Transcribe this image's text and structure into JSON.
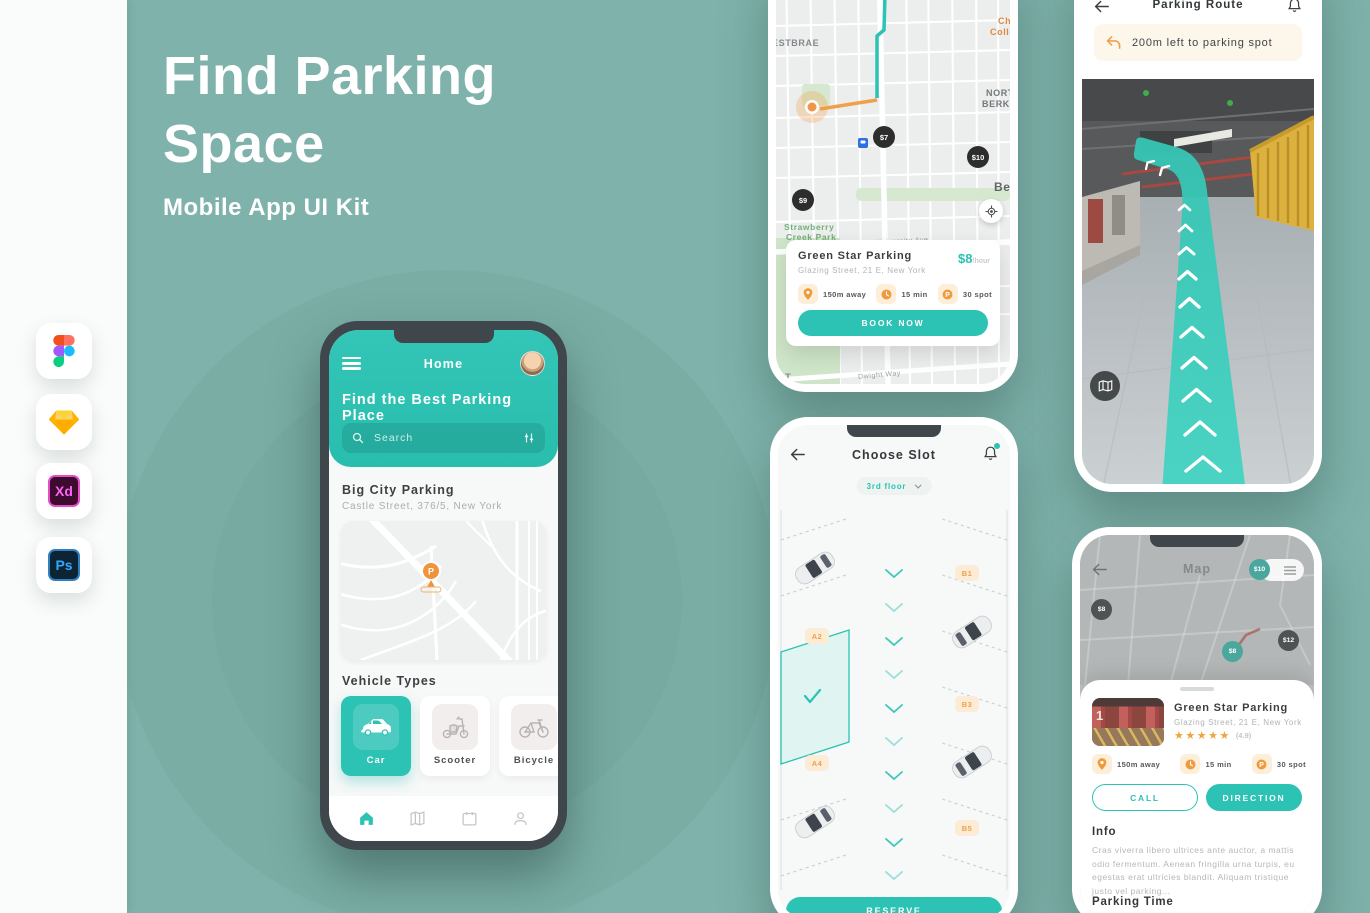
{
  "colors": {
    "accent": "#2cc2b4",
    "orange": "#f09a3e",
    "background": "#7eb2aa",
    "pin_dark": "#2d2d2d"
  },
  "hero": {
    "line1": "Find Parking",
    "line2": "Space",
    "subtitle": "Mobile App UI Kit"
  },
  "tools": {
    "xd": "Xd",
    "ps": "Ps"
  },
  "home": {
    "nav_title": "Home",
    "heading": "Find the Best Parking Place",
    "search_placeholder": "Search",
    "place_name": "Big City Parking",
    "place_address": "Castle Street, 376/5, New York",
    "vehicle_section": "Vehicle Types",
    "vehicles": [
      {
        "label": "Car"
      },
      {
        "label": "Scooter"
      },
      {
        "label": "Bicycle"
      }
    ]
  },
  "map": {
    "labels": {
      "westbrae": "ESTBRAE",
      "collection1": "Che",
      "collection2": "Collecti",
      "north1": "NORT",
      "north2": "BERKEL",
      "berkeley": "Ber",
      "park1": "Strawberry",
      "park2": "Creek Park",
      "university": "University Ave",
      "dwight": "Dwight Way",
      "est": "EST"
    },
    "pins": [
      {
        "price": "$7"
      },
      {
        "price": "$10"
      },
      {
        "price": "$9"
      }
    ],
    "card": {
      "name": "Green Star Parking",
      "address": "Glazing Street, 21 E, New York",
      "price": "$8",
      "price_unit": "/hour",
      "stats": [
        {
          "label": "150m away"
        },
        {
          "label": "15 min"
        },
        {
          "label": "30 spot"
        }
      ],
      "cta": "BOOK NOW"
    }
  },
  "slot": {
    "nav_title": "Choose Slot",
    "floor": "3rd floor",
    "left_labels": [
      {
        "id": "A2"
      },
      {
        "id": "A4"
      }
    ],
    "right_labels": [
      {
        "id": "B1"
      },
      {
        "id": "B3"
      },
      {
        "id": "B5"
      }
    ],
    "cta": "RESERVE"
  },
  "route": {
    "nav_title": "Parking Route",
    "banner": "200m left to parking spot"
  },
  "detail": {
    "nav_title": "Map",
    "pins": [
      {
        "price": "$10"
      },
      {
        "price": "$8"
      },
      {
        "price": "$8"
      },
      {
        "price": "$12"
      }
    ],
    "card": {
      "thumb_number": "1",
      "name": "Green Star Parking",
      "address": "Glazing Street, 21 E, New York",
      "stars": "★★★★★",
      "rating": "(4.9)",
      "stats": [
        {
          "label": "150m away"
        },
        {
          "label": "15 min"
        },
        {
          "label": "30 spot"
        }
      ],
      "call": "CALL",
      "direction": "DIRECTION",
      "info_title": "Info",
      "info_text": "Cras viverra libero ultrices ante auctor, a mattis odio fermentum. Aenean fringilla urna turpis, eu egestas erat ultricies blandit. Aliquam tristique justo vel parking...",
      "time_title": "Parking Time"
    }
  }
}
